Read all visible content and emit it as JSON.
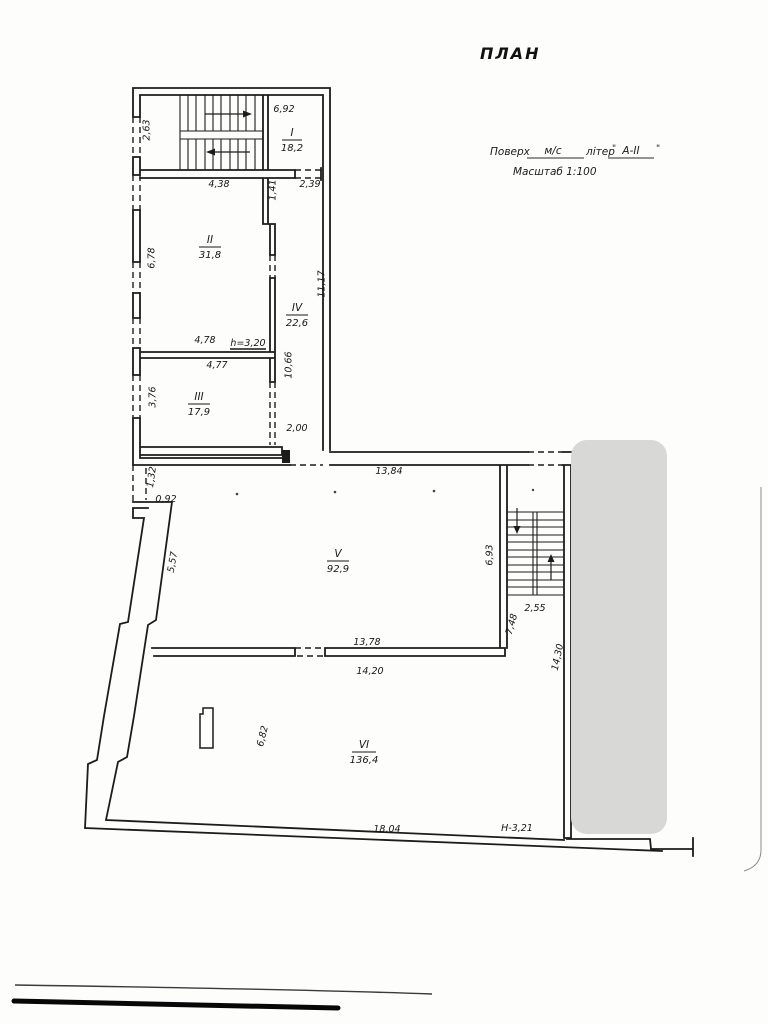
{
  "title": "ПЛАН",
  "title_block": {
    "floor_label": "Поверх",
    "floor_value": "м/с",
    "liter_label": "літер",
    "liter_quote_open": "\"",
    "liter_value": "А-ІІ",
    "liter_quote_close": "\"",
    "scale": "Масштаб 1:100"
  },
  "rooms": [
    {
      "number": "I",
      "area": "18,2"
    },
    {
      "number": "II",
      "area": "31,8"
    },
    {
      "number": "III",
      "area": "17,9"
    },
    {
      "number": "IV",
      "area": "22,6"
    },
    {
      "number": "V",
      "area": "92,9"
    },
    {
      "number": "VI",
      "area": "136,4"
    }
  ],
  "dimensions": {
    "stair_hall_width": "6,92",
    "vestibule_depth": "2,63",
    "room2_top": "4,38",
    "corridor_top_width": "1,41",
    "passage_width": "2,39",
    "room2_left": "6,78",
    "corridor_length": "11,17",
    "room2_bottom": "4,78",
    "ceiling_height": "h=3,20",
    "corridor_mid": "10,66",
    "room3_top": "4,77",
    "room3_left": "3,76",
    "corridor_bottom_width": "2,00",
    "wall_step_left": "1,32",
    "wall_step_top": "0,92",
    "room5_top": "13,84",
    "room5_left_slant": "5,57",
    "room5_right": "6,93",
    "stair2_width": "2,55",
    "stair2_passage": "7,48",
    "right_wall_length": "14,30",
    "room5_bottom": "13,78",
    "room6_top": "14,20",
    "room6_left": "6,82",
    "room6_bottom": "18,04",
    "level_mark": "Н-3,21"
  }
}
